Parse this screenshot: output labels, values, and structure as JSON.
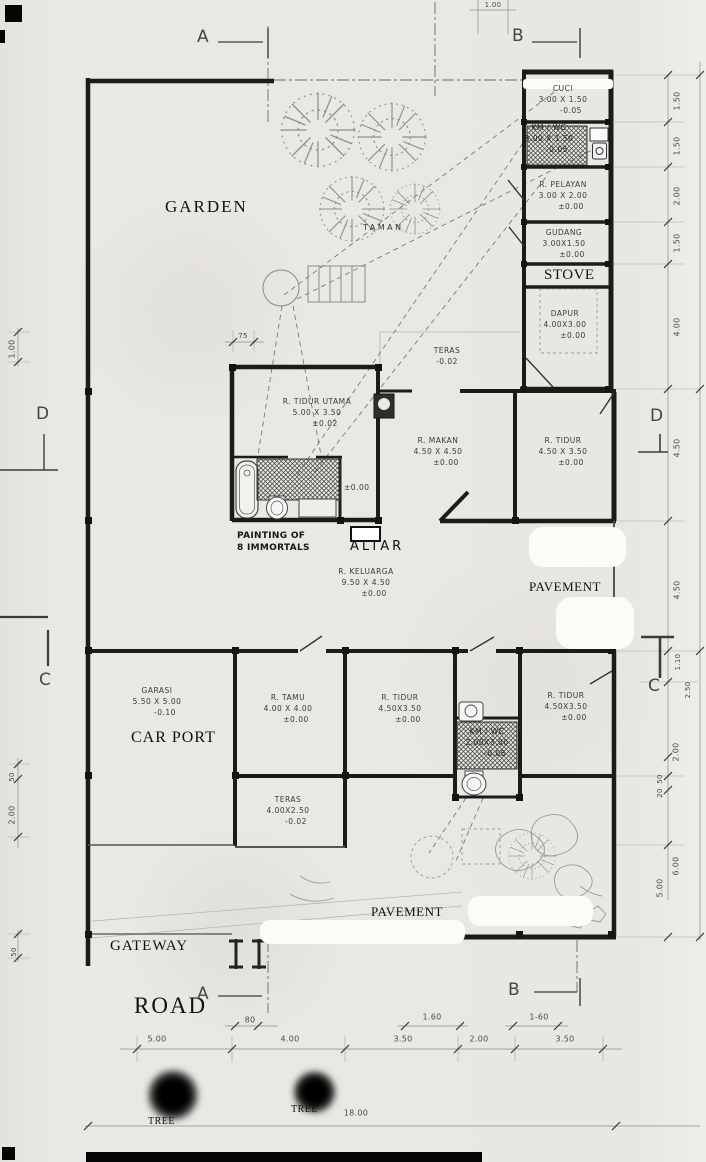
{
  "colors": {
    "paper": "#e9e7e2",
    "ink": "#1b1b1b",
    "pencil": "#8f8f8f",
    "whiteout": "#fbfbf8"
  },
  "icons": {
    "garden_tree": "tree-icon",
    "bathtub": "bathtub-icon",
    "toilet": "toilet-icon",
    "washbasin": "washbasin-icon",
    "sink": "sink-icon",
    "gate_post": "gate-icon",
    "planter": "planter-circle-icon",
    "pergola": "pergola-icon"
  },
  "grid_letters": {
    "a_top": "A",
    "b_top": "B",
    "a_bottom": "A",
    "b_bottom": "B",
    "d_left": "D",
    "d_right": "D",
    "c_left": "C",
    "c_right": "C"
  },
  "area_labels": {
    "garden": "GARDEN",
    "taman": "TAMAN",
    "stove": "STOVE",
    "painting_line1": "PAINTING OF",
    "painting_line2": "8 IMMORTALS",
    "altar": "ALTAR",
    "pavement_side": "PAVEMENT",
    "pavement_front": "PAVEMENT",
    "car_port": "CAR PORT",
    "gateway": "GATEWAY",
    "road": "ROAD",
    "tree_left": "TREE",
    "tree_right": "TREE"
  },
  "levels": {
    "hall": "±0.00"
  },
  "rooms": [
    {
      "name": "CUCI",
      "dims": "3.00 X 1.50",
      "level": "-0.05"
    },
    {
      "name": "KM / WC",
      "dims": "3.00 X 1.50",
      "level": "-0.05"
    },
    {
      "name": "R. PELAYAN",
      "dims": "3.00 X 2.00",
      "level": "±0.00"
    },
    {
      "name": "GUDANG",
      "dims": "3.00X1.50",
      "level": "±0.00"
    },
    {
      "name": "DAPUR",
      "dims": "4.00X3.00",
      "level": "±0.00"
    },
    {
      "name": "TERAS",
      "dims": "",
      "level": "-0.02"
    },
    {
      "name": "R. TIDUR UTAMA",
      "dims": "5.00 X 3.50",
      "level": "±0.02"
    },
    {
      "name": "R. MAKAN",
      "dims": "4.50 X 4.50",
      "level": "±0.00"
    },
    {
      "name": "R. TIDUR",
      "dims": "4.50 X 3.50",
      "level": "±0.00"
    },
    {
      "name": "R. KELUARGA",
      "dims": "9.50 X 4.50",
      "level": "±0.00"
    },
    {
      "name": "GARASI",
      "dims": "5.50 X 5.00",
      "level": "-0.10"
    },
    {
      "name": "R. TAMU",
      "dims": "4.00 X 4.00",
      "level": "±0.00"
    },
    {
      "name": "R. TIDUR",
      "dims": "4.50X3.50",
      "level": "±0.00"
    },
    {
      "name": "KM / WC",
      "dims": "2.00X3.00",
      "level": "-0.05"
    },
    {
      "name": "R. TIDUR",
      "dims": "4.50X3.50",
      "level": "±0.00"
    },
    {
      "name": "TERAS",
      "dims": "4.00X2.50",
      "level": "-0.02"
    }
  ],
  "dims": {
    "left": [
      {
        "t": "1.00"
      },
      {
        "t": "50"
      },
      {
        "t": "2.00"
      },
      {
        "t": "50"
      }
    ],
    "right": [
      {
        "t": "1.50"
      },
      {
        "t": "1.50"
      },
      {
        "t": "2.00"
      },
      {
        "t": "1.50"
      },
      {
        "t": "4.00"
      },
      {
        "t": "4.50"
      },
      {
        "t": "4.50"
      },
      {
        "t": "1.10"
      },
      {
        "t": "2.50"
      },
      {
        "t": "2.00"
      },
      {
        "t": "50"
      },
      {
        "t": "20"
      },
      {
        "t": "6.00"
      },
      {
        "t": "5.00"
      }
    ],
    "bottom": [
      {
        "t": "80"
      },
      {
        "t": "1.60"
      },
      {
        "t": "1-60"
      },
      {
        "t": "5.00"
      },
      {
        "t": "4.00"
      },
      {
        "t": "3.50"
      },
      {
        "t": "2.00"
      },
      {
        "t": "3.50"
      },
      {
        "t": "18.00"
      }
    ],
    "top": [
      {
        "t": "1.00"
      },
      {
        "t": "75"
      }
    ]
  }
}
